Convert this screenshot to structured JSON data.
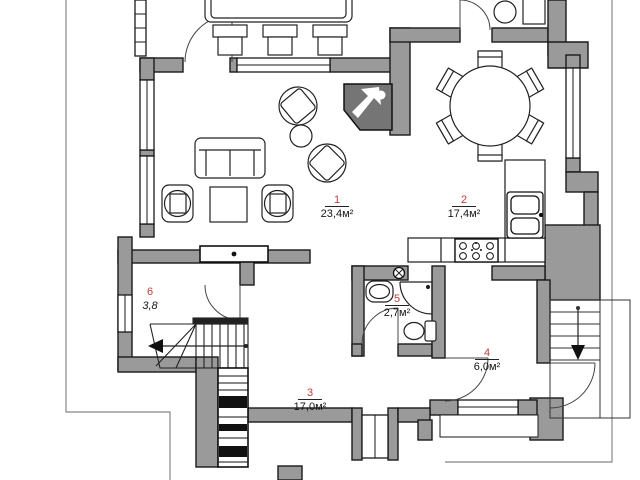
{
  "plan_title": "Ground floor plan",
  "rooms": [
    {
      "number": "1",
      "area": "23,4м²",
      "name": "living-room"
    },
    {
      "number": "2",
      "area": "17,4м²",
      "name": "dining-kitchen"
    },
    {
      "number": "3",
      "area": "17,0м²",
      "name": "hall"
    },
    {
      "number": "4",
      "area": "6,0м²",
      "name": "entry"
    },
    {
      "number": "5",
      "area": "2,7м²",
      "name": "bathroom"
    },
    {
      "number": "6",
      "area": "3,8",
      "name": "stair-hall"
    }
  ],
  "colors": {
    "wall_fill": "#9a9a9a",
    "fireplace_fill": "#757575",
    "outline": "#1a1a1a",
    "room_number": "#c43b3b",
    "boundary_line": "#888888",
    "background": "#ffffff"
  }
}
